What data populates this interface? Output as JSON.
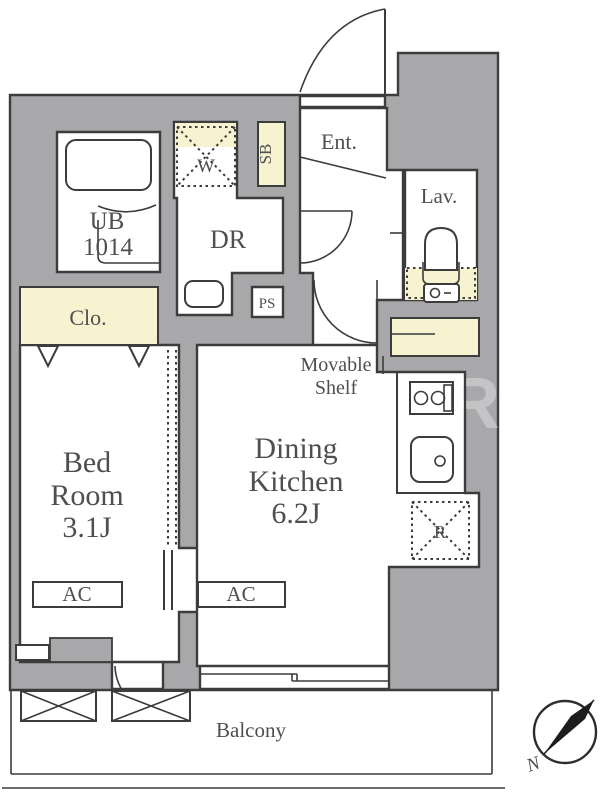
{
  "labels": {
    "ub1": "UB",
    "ub2": "1014",
    "w": "W",
    "sb": "SB",
    "ent": "Ent.",
    "dr": "DR",
    "lav": "Lav.",
    "ps": "PS",
    "clo": "Clo.",
    "shelf1": "Movable",
    "shelf2": "Shelf",
    "bed1": "Bed",
    "bed2": "Room",
    "bed3": "3.1J",
    "dk1": "Dining",
    "dk2": "Kitchen",
    "dk3": "6.2J",
    "r": "R",
    "ac_bed": "AC",
    "ac_dk": "AC",
    "balcony": "Balcony",
    "compass_n": "N",
    "watermark": "R"
  },
  "rooms": {
    "bed_room": {
      "name": "Bed Room",
      "size_tatami": "3.1J"
    },
    "dining_kitchen": {
      "name": "Dining Kitchen",
      "size_tatami": "6.2J"
    },
    "unit_bath": {
      "name": "UB",
      "size": "1014"
    },
    "balcony": {
      "name": "Balcony"
    }
  },
  "colors": {
    "wall_fill": "#a8a8ab",
    "line": "#3c3c3c",
    "accent_cream": "#f7f2cf",
    "room_white": "#ffffff",
    "text": "#4f4f4f"
  }
}
